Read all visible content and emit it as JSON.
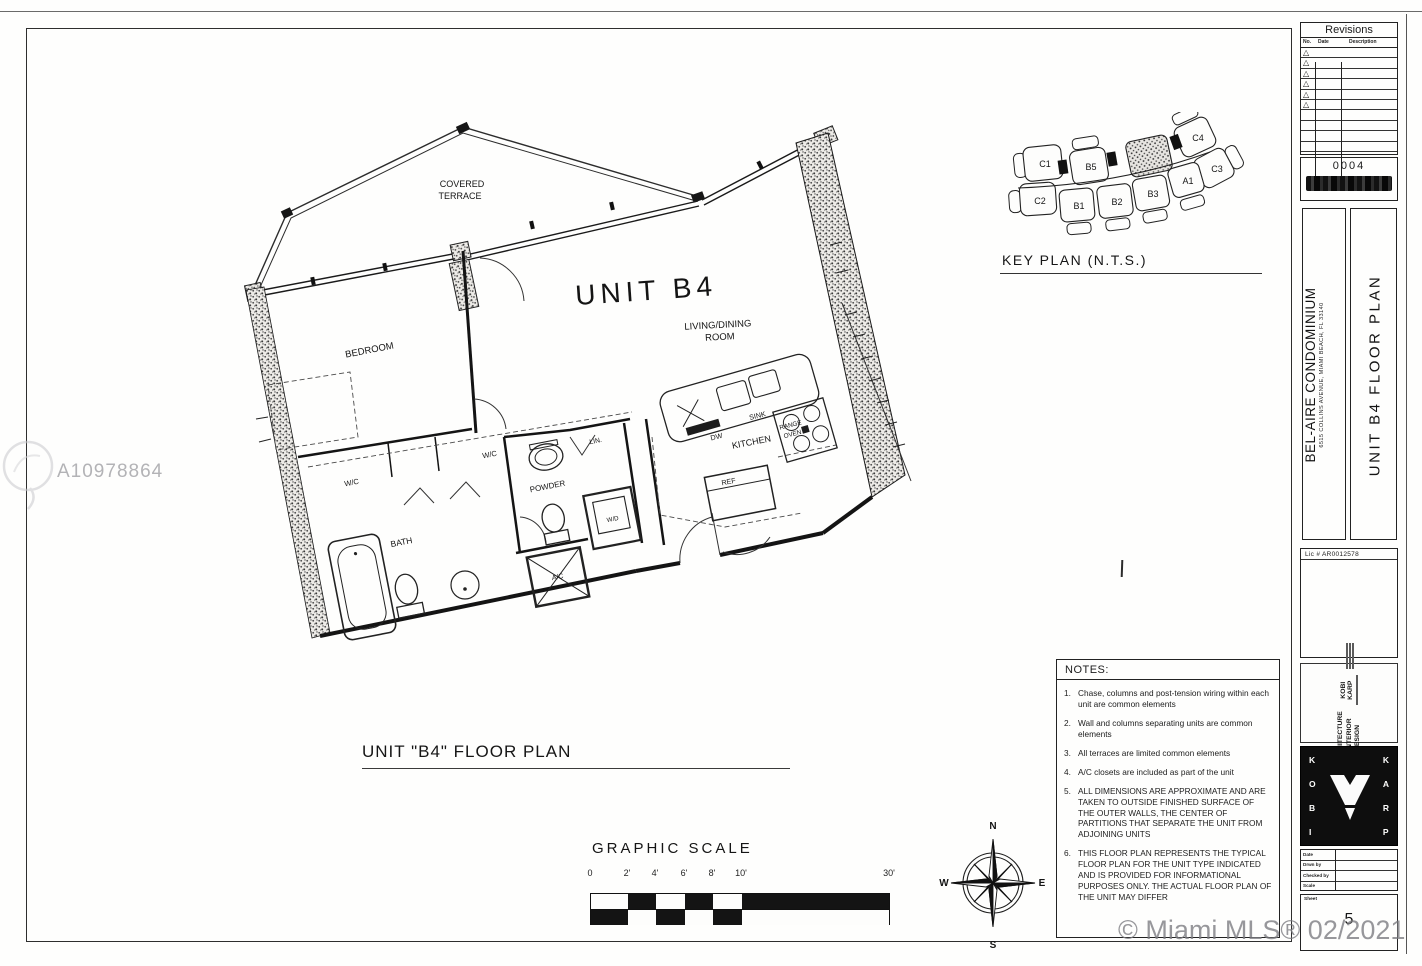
{
  "watermark": {
    "listing_id": "A10978864",
    "mls_credit": "© Miami MLS® 02/2021"
  },
  "revisions": {
    "title": "Revisions",
    "columns": [
      "No.",
      "Date",
      "Description"
    ]
  },
  "stamp_number": "0004",
  "title_block": {
    "project": "BEL-AIRE CONDOMINIUM",
    "address": "6515 COLLINS AVENUE, MIAMI BEACH, FL  33140",
    "sheet_title": "UNIT B4 FLOOR PLAN",
    "license": "Lic # AR0012578",
    "firm_tagline_1": "ARCHITECTURE",
    "firm_tagline_2": "& INTERIOR",
    "firm_tagline_3": "DESIGN",
    "firm_name": "KOBI KARP",
    "logo_word_left": "KOBI",
    "logo_word_right": "KARP",
    "info_labels": [
      "Date",
      "Drwn by",
      "Checked by",
      "Scale"
    ],
    "sheet_label": "Sheet",
    "sheet_number": "5"
  },
  "key_plan": {
    "label": "KEY PLAN (N.T.S.)",
    "units": [
      "C1",
      "B5",
      "C4",
      "C2",
      "B1",
      "B2",
      "B3",
      "A1",
      "C3"
    ],
    "highlighted_unit": "B4"
  },
  "plan": {
    "title": "UNIT \"B4\" FLOOR PLAN",
    "unit_name": "UNIT B4",
    "rooms": {
      "covered_terrace_1": "COVERED",
      "covered_terrace_2": "TERRACE",
      "bedroom": "BEDROOM",
      "living_1": "LIVING/DINING",
      "living_2": "ROOM",
      "kitchen": "KITCHEN",
      "bath": "BATH",
      "powder": "POWDER",
      "wic_a": "W/C",
      "wic_b": "W/C",
      "linen": "LIN.",
      "washer_dryer": "W/D",
      "ac_closet": "A/C",
      "sink": "SINK",
      "dishwasher": "DW",
      "range_1": "RANGE",
      "range_2": "OVEN",
      "refrigerator": "REF"
    }
  },
  "graphic_scale": {
    "title": "GRAPHIC SCALE",
    "ticks": [
      "0",
      "2'",
      "4'",
      "6'",
      "8'",
      "10'",
      "30'"
    ]
  },
  "compass": {
    "north": "N",
    "south": "S",
    "east": "E",
    "west": "W"
  },
  "notes": {
    "title": "NOTES:",
    "items": [
      {
        "num": "1.",
        "text": "Chase, columns and post-tension wiring within each unit are common elements"
      },
      {
        "num": "2.",
        "text": "Wall and columns separating units are common elements"
      },
      {
        "num": "3.",
        "text": "All terraces are limited common elements"
      },
      {
        "num": "4.",
        "text": "A/C closets are included as part of the unit"
      },
      {
        "num": "5.",
        "text": "ALL DIMENSIONS ARE APPROXIMATE AND ARE TAKEN TO OUTSIDE FINISHED SURFACE OF THE OUTER WALLS, THE CENTER OF PARTITIONS THAT SEPARATE THE UNIT FROM ADJOINING UNITS"
      },
      {
        "num": "6.",
        "text": "THIS FLOOR PLAN REPRESENTS THE TYPICAL FLOOR PLAN FOR THE UNIT TYPE INDICATED AND IS PROVIDED FOR INFORMATIONAL PURPOSES ONLY.  THE ACTUAL FLOOR PLAN OF THE UNIT MAY DIFFER"
      }
    ]
  }
}
